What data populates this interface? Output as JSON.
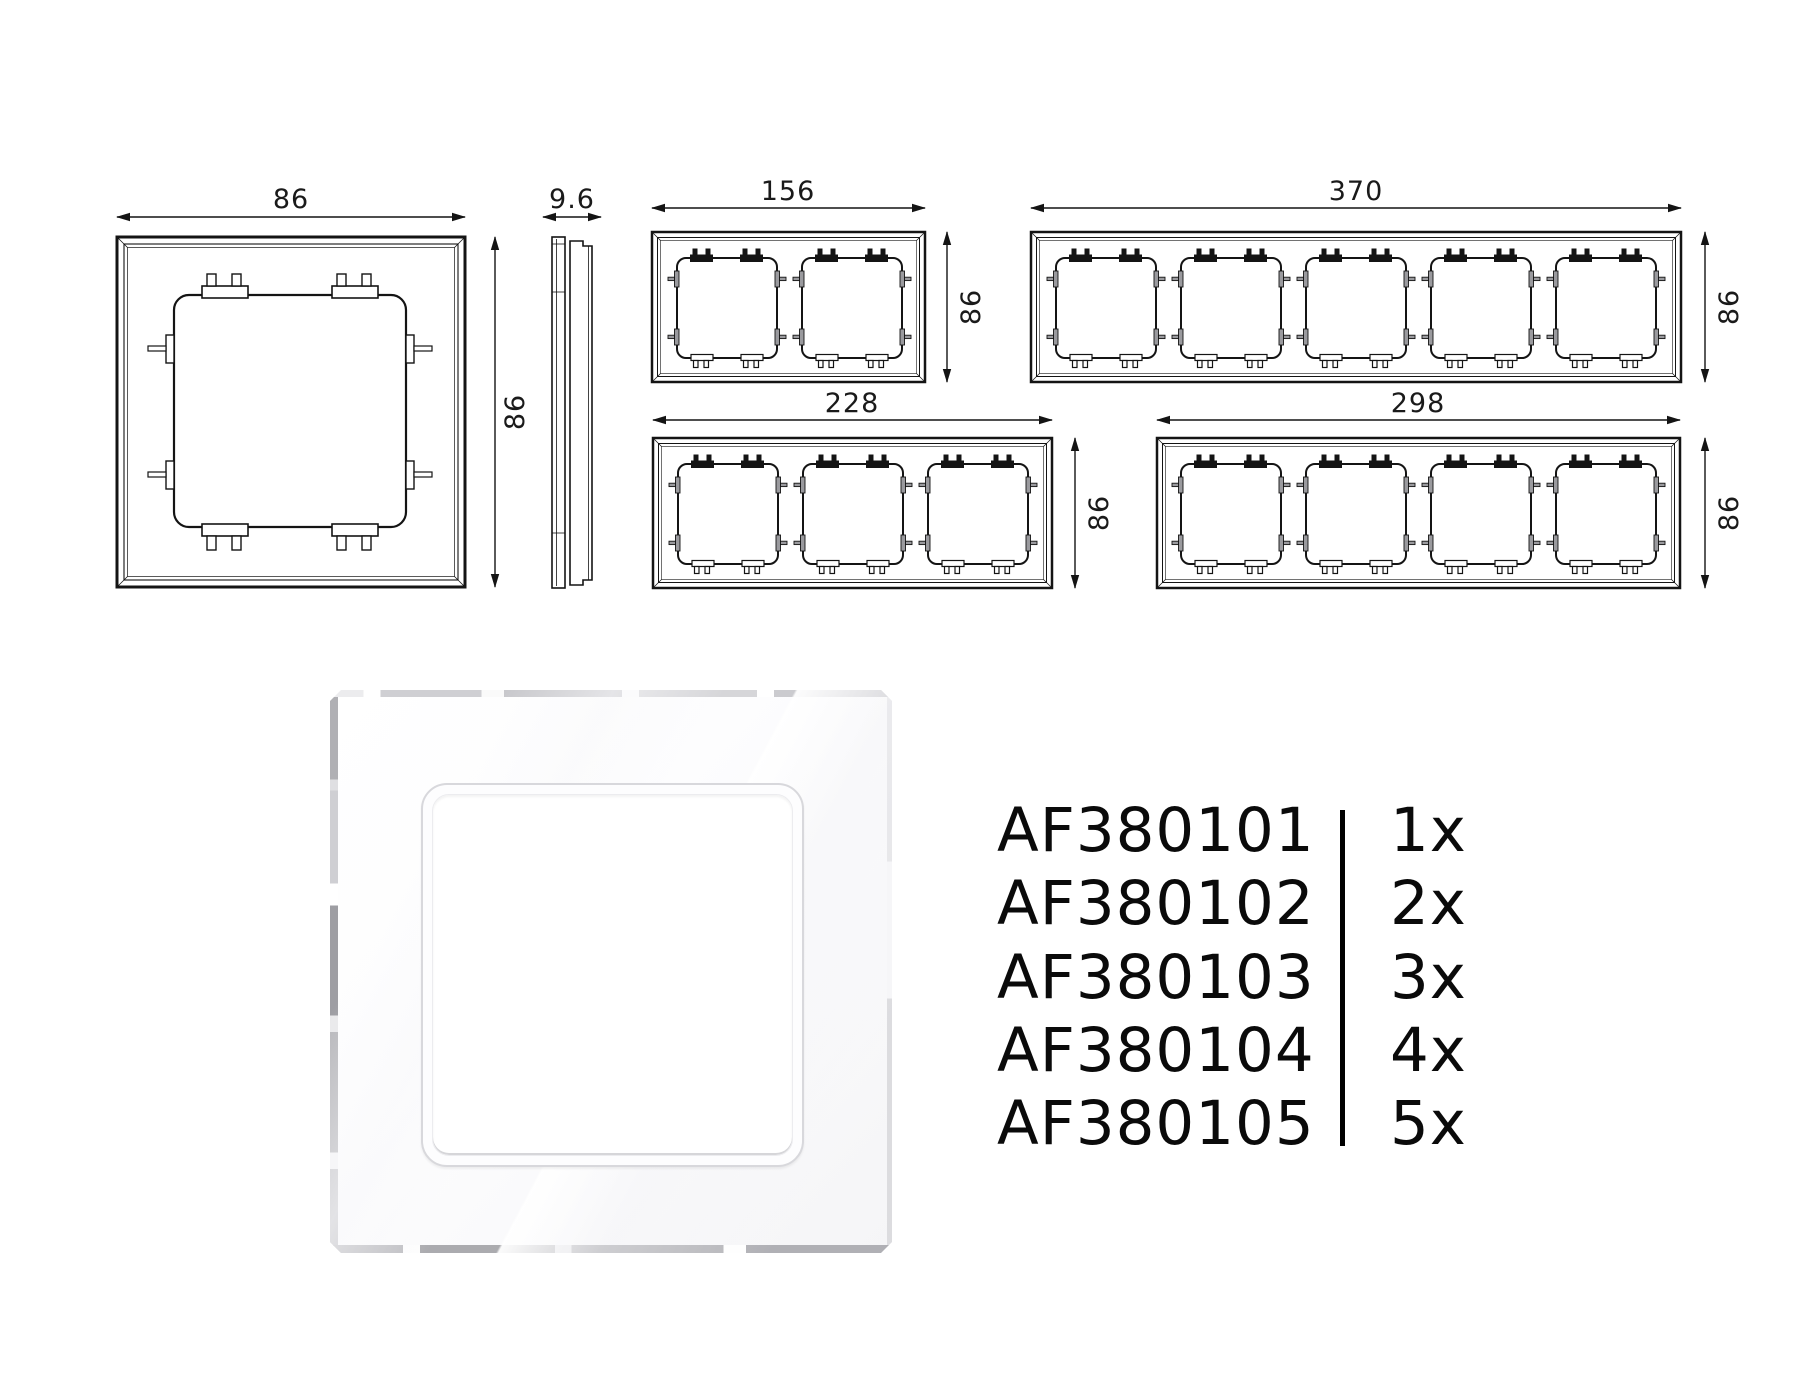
{
  "drawings": {
    "single_front": {
      "width_label": "86",
      "height_label": "86"
    },
    "side_profile": {
      "depth_label": "9.6"
    },
    "frame_2gang": {
      "width_label": "156",
      "height_label": "86"
    },
    "frame_5gang": {
      "width_label": "370",
      "height_label": "86"
    },
    "frame_3gang": {
      "width_label": "228",
      "height_label": "86"
    },
    "frame_4gang": {
      "width_label": "298",
      "height_label": "86"
    }
  },
  "part_table": {
    "rows": [
      {
        "code": "AF380101",
        "quantity": "1x"
      },
      {
        "code": "AF380102",
        "quantity": "2x"
      },
      {
        "code": "AF380103",
        "quantity": "3x"
      },
      {
        "code": "AF380104",
        "quantity": "4x"
      },
      {
        "code": "AF380105",
        "quantity": "5x"
      }
    ]
  }
}
